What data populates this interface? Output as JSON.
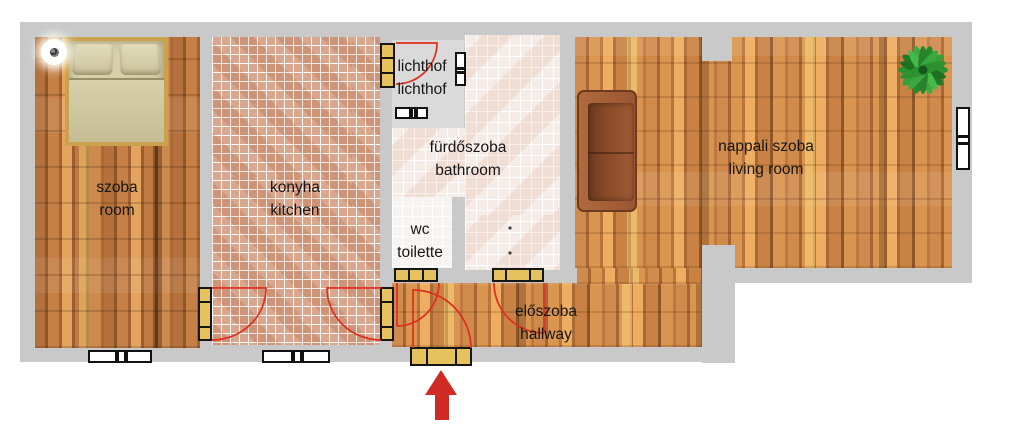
{
  "plan": {
    "type": "apartment floor plan",
    "entrance_marker": "red arrow pointing to entrance door",
    "rooms": [
      {
        "key": "szoba",
        "label_hu": "szoba",
        "label_en": "room"
      },
      {
        "key": "konyha",
        "label_hu": "konyha",
        "label_en": "kitchen"
      },
      {
        "key": "lichthof",
        "label_hu": "lichthof",
        "label_en": "lichthof"
      },
      {
        "key": "furdoszoba",
        "label_hu": "fürdőszoba",
        "label_en": "bathroom"
      },
      {
        "key": "wc",
        "label_hu": "wc",
        "label_en": "toilette"
      },
      {
        "key": "eloszoba",
        "label_hu": "előszoba",
        "label_en": "hallway"
      },
      {
        "key": "nappali",
        "label_hu": "nappali szoba",
        "label_en": "living room"
      }
    ],
    "furniture": [
      "double bed",
      "ceiling lamp",
      "sofa",
      "plant"
    ],
    "colors": {
      "wall": "#c9c9c9",
      "lichthof_floor": "#dadada",
      "wood_dark": "#a96835",
      "wood_light": "#c47d42",
      "kitchen_tile": "#d69d81",
      "bath_tile": "#f2e7e1",
      "wc_tile": "#f7f3f0",
      "door_panel": "#e6c25e",
      "door_frame": "#151515",
      "swing_red": "#dd2e1f",
      "arrow_red": "#cf2a25",
      "sofa": "#a05c36",
      "bed": "#d8d0ad",
      "plant": "#2f9e33"
    }
  }
}
